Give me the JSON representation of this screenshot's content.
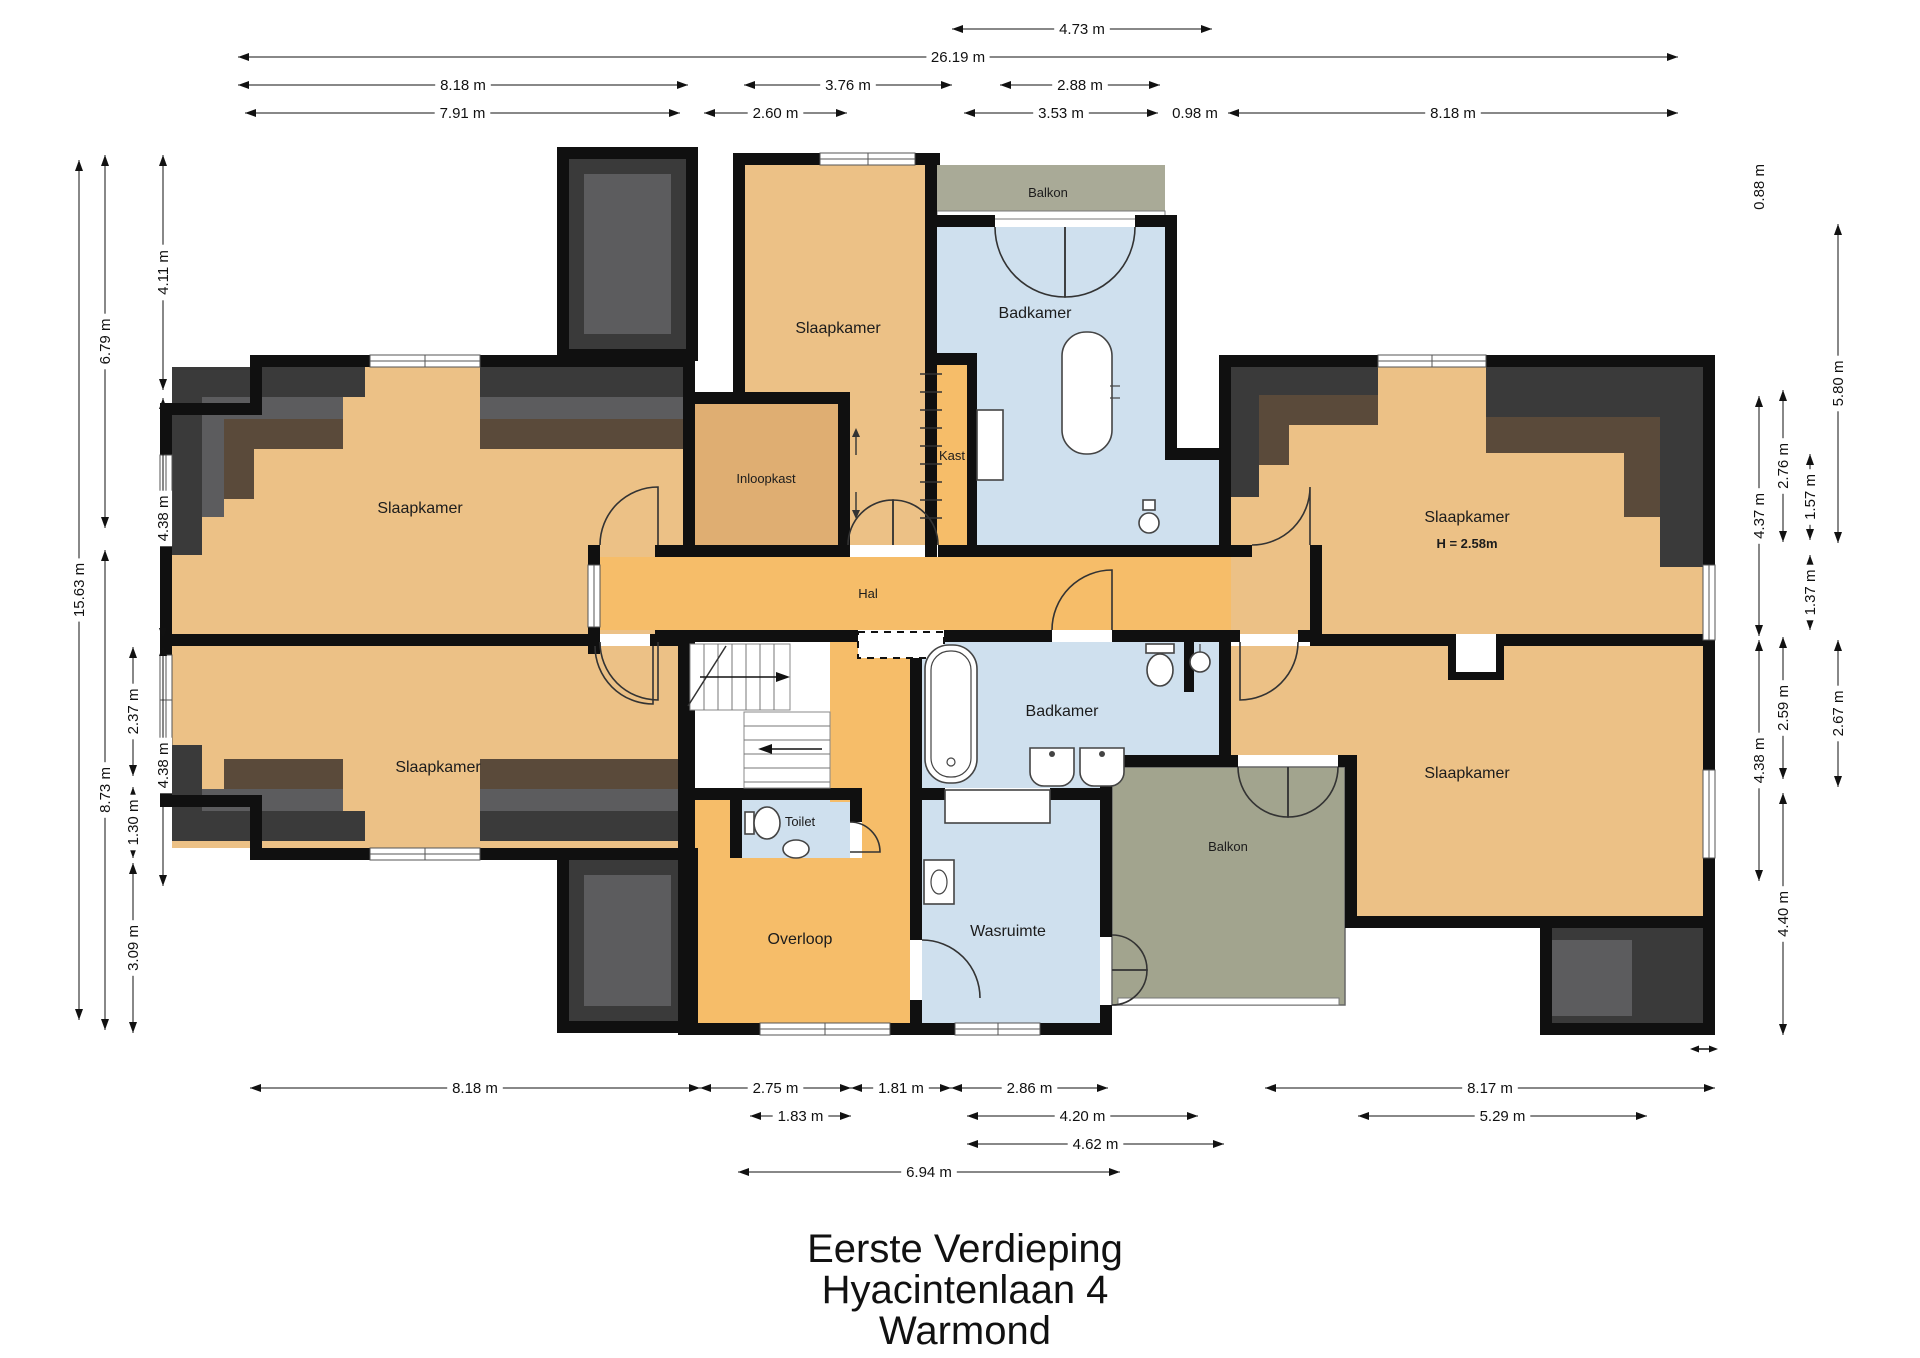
{
  "title": {
    "line1": "Eerste Verdieping",
    "line2": "Hyacintenlaan 4",
    "line3": "Warmond"
  },
  "rooms": {
    "slaapkamer_tl": "Slaapkamer",
    "slaapkamer_bl": "Slaapkamer",
    "slaapkamer_tc": "Slaapkamer",
    "inloopkast": "Inloopkast",
    "kast": "Kast",
    "badkamer_top": "Badkamer",
    "balkon_top": "Balkon",
    "hal": "Hal",
    "toilet": "Toilet",
    "overloop": "Overloop",
    "badkamer_mid": "Badkamer",
    "wasruimte": "Wasruimte",
    "balkon_bottom": "Balkon",
    "slaapkamer_tr": "Slaapkamer",
    "slaapkamer_tr_height": "H = 2.58m",
    "slaapkamer_br": "Slaapkamer"
  },
  "colors": {
    "floor_orange": "#ecc186",
    "hal_orange": "#f6bd69",
    "closet_orange": "#dfae72",
    "bath_blue": "#cfe0ee",
    "balcony_olive_top": "#a9aa97",
    "balcony_olive_bottom": "#a2a48e",
    "roof_dark": "#3a3a3a",
    "roof_mid": "#5c5c5e",
    "roof_brown": "#5a4a3a",
    "wall_black": "#101010"
  },
  "dimensions": [
    {
      "label": "4.73 m",
      "o": "h",
      "x1": 952,
      "x2": 1212,
      "y": 29
    },
    {
      "label": "26.19 m",
      "o": "h",
      "x1": 238,
      "x2": 1678,
      "y": 57
    },
    {
      "label": "8.18 m",
      "o": "h",
      "x1": 238,
      "x2": 688,
      "y": 85
    },
    {
      "label": "3.76 m",
      "o": "h",
      "x1": 744,
      "x2": 952,
      "y": 85
    },
    {
      "label": "2.88 m",
      "o": "h",
      "x1": 1000,
      "x2": 1160,
      "y": 85
    },
    {
      "label": "7.91 m",
      "o": "h",
      "x1": 245,
      "x2": 680,
      "y": 113
    },
    {
      "label": "2.60 m",
      "o": "h",
      "x1": 704,
      "x2": 847,
      "y": 113
    },
    {
      "label": "3.53 m",
      "o": "h",
      "x1": 964,
      "x2": 1158,
      "y": 113
    },
    {
      "label": "0.98 m",
      "o": "h",
      "x1": 1168,
      "x2": 1222,
      "y": 113
    },
    {
      "label": "8.18 m",
      "o": "h",
      "x1": 1228,
      "x2": 1678,
      "y": 113
    },
    {
      "label": "8.18 m",
      "o": "h",
      "x1": 250,
      "x2": 700,
      "y": 1088
    },
    {
      "label": "2.75 m",
      "o": "h",
      "x1": 700,
      "x2": 851,
      "y": 1088
    },
    {
      "label": "1.81 m",
      "o": "h",
      "x1": 851,
      "x2": 951,
      "y": 1088
    },
    {
      "label": "2.86 m",
      "o": "h",
      "x1": 951,
      "x2": 1108,
      "y": 1088
    },
    {
      "label": "8.17 m",
      "o": "h",
      "x1": 1265,
      "x2": 1715,
      "y": 1088
    },
    {
      "label": "1.83 m",
      "o": "h",
      "x1": 750,
      "x2": 851,
      "y": 1116
    },
    {
      "label": "4.20 m",
      "o": "h",
      "x1": 967,
      "x2": 1198,
      "y": 1116
    },
    {
      "label": "5.29 m",
      "o": "h",
      "x1": 1358,
      "x2": 1647,
      "y": 1116
    },
    {
      "label": "4.62 m",
      "o": "h",
      "x1": 967,
      "x2": 1224,
      "y": 1144
    },
    {
      "label": "6.94 m",
      "o": "h",
      "x1": 738,
      "x2": 1120,
      "y": 1172
    },
    {
      "label": "15.63 m",
      "o": "v",
      "y1": 160,
      "y2": 1020,
      "x": 79
    },
    {
      "label": "6.79 m",
      "o": "v",
      "y1": 155,
      "y2": 528,
      "x": 105
    },
    {
      "label": "8.73 m",
      "o": "v",
      "y1": 550,
      "y2": 1030,
      "x": 105
    },
    {
      "label": "2.37 m",
      "o": "v",
      "y1": 647,
      "y2": 776,
      "x": 133
    },
    {
      "label": "1.30 m",
      "o": "v",
      "y1": 787,
      "y2": 858,
      "x": 133
    },
    {
      "label": "3.09 m",
      "o": "v",
      "y1": 863,
      "y2": 1033,
      "x": 133
    },
    {
      "label": "4.11 m",
      "o": "v",
      "y1": 155,
      "y2": 390,
      "x": 163
    },
    {
      "label": "4.38 m",
      "o": "v",
      "y1": 398,
      "y2": 639,
      "x": 163
    },
    {
      "label": "4.38 m",
      "o": "v",
      "y1": 645,
      "y2": 886,
      "x": 163
    },
    {
      "label": "0.88 m",
      "o": "v",
      "y1": 163,
      "y2": 211,
      "x": 1759
    },
    {
      "label": "4.37 m",
      "o": "v",
      "y1": 396,
      "y2": 636,
      "x": 1759
    },
    {
      "label": "4.38 m",
      "o": "v",
      "y1": 640,
      "y2": 881,
      "x": 1759
    },
    {
      "label": "2.76 m",
      "o": "v",
      "y1": 390,
      "y2": 542,
      "x": 1783
    },
    {
      "label": "2.59 m",
      "o": "v",
      "y1": 637,
      "y2": 779,
      "x": 1783
    },
    {
      "label": "4.40 m",
      "o": "v",
      "y1": 793,
      "y2": 1035,
      "x": 1783
    },
    {
      "label": "1.57 m",
      "o": "v",
      "y1": 454,
      "y2": 540,
      "x": 1810
    },
    {
      "label": "1.37 m",
      "o": "v",
      "y1": 555,
      "y2": 630,
      "x": 1810
    },
    {
      "label": "5.80 m",
      "o": "v",
      "y1": 224,
      "y2": 543,
      "x": 1838
    },
    {
      "label": "2.67 m",
      "o": "v",
      "y1": 640,
      "y2": 787,
      "x": 1838
    }
  ]
}
